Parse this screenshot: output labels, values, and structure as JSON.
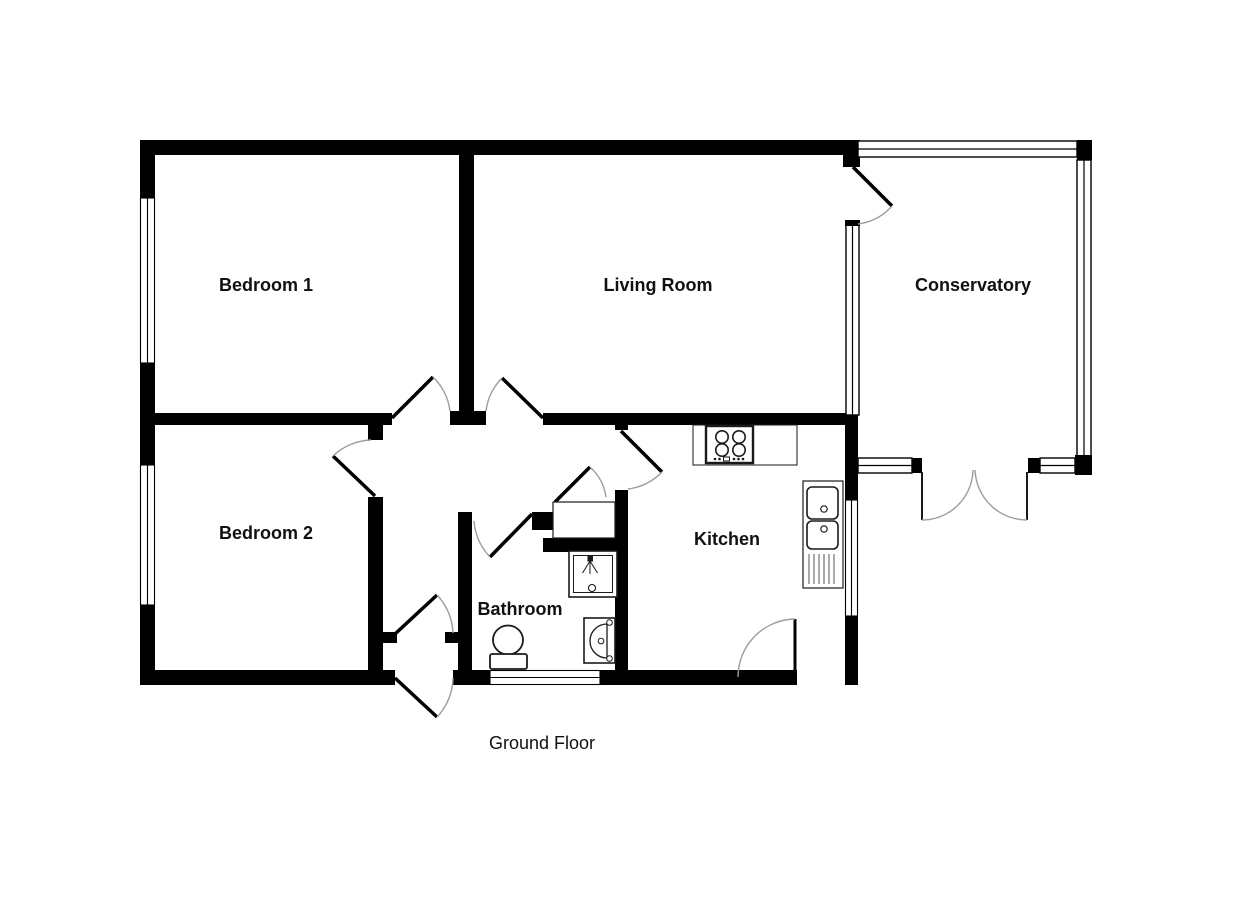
{
  "title": {
    "floor_label": "Ground Floor"
  },
  "rooms": [
    {
      "label": "Bedroom 1"
    },
    {
      "label": "Bedroom 2"
    },
    {
      "label": "Living Room"
    },
    {
      "label": "Conservatory"
    },
    {
      "label": "Kitchen"
    },
    {
      "label": "Bathroom"
    }
  ],
  "doors": [
    {
      "name": "bedroom-1-door"
    },
    {
      "name": "bedroom-2-door"
    },
    {
      "name": "living-room-door"
    },
    {
      "name": "bathroom-door"
    },
    {
      "name": "airing-cupboard-door"
    },
    {
      "name": "kitchen-door"
    },
    {
      "name": "conservatory-door"
    },
    {
      "name": "kitchen-back-door"
    },
    {
      "name": "front-door"
    },
    {
      "name": "hall-vestibule-door"
    },
    {
      "name": "conservatory-french-doors"
    }
  ],
  "windows": [
    {
      "name": "bedroom-1-window"
    },
    {
      "name": "bedroom-2-window"
    },
    {
      "name": "bathroom-window"
    },
    {
      "name": "kitchen-window"
    },
    {
      "name": "conservatory-glazing"
    }
  ],
  "fixtures": [
    {
      "name": "hob"
    },
    {
      "name": "sink-double-bowl-with-drainer"
    },
    {
      "name": "shower-tray"
    },
    {
      "name": "wash-basin"
    },
    {
      "name": "toilet"
    },
    {
      "name": "airing-cupboard"
    }
  ],
  "colors": {
    "wall": "#000000",
    "background": "#ffffff",
    "door_arc": "#9c9c9c",
    "label_text": "#111111"
  }
}
